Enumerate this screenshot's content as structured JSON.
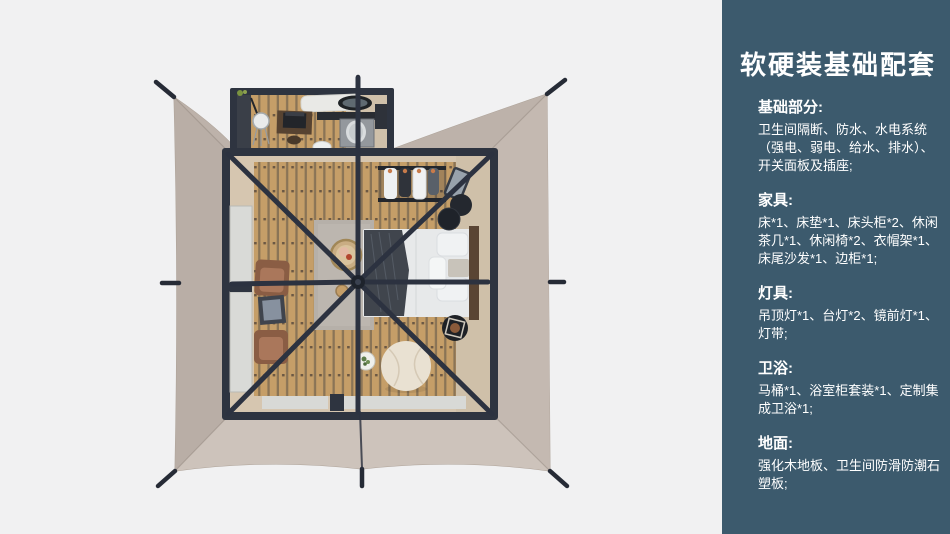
{
  "panel": {
    "title": "软硬装基础配套",
    "sections": [
      {
        "heading": "基础部分:",
        "lines": [
          "卫生间隔断、防水、水电系统",
          "（强电、弱电、给水、排水）、",
          "开关面板及插座;"
        ]
      },
      {
        "heading": "家具:",
        "lines": [
          "床*1、床垫*1、床头柜*2、休闲",
          "茶几*1、休闲椅*2、衣帽架*1、",
          "床尾沙发*1、边柜*1;"
        ]
      },
      {
        "heading": "灯具:",
        "lines": [
          "吊顶灯*1、台灯*2、镜前灯*1、",
          "灯带;"
        ]
      },
      {
        "heading": "卫浴:",
        "lines": [
          "马桶*1、浴室柜套装*1、定制集",
          "成卫浴*1;"
        ]
      },
      {
        "heading": "地面:",
        "lines": [
          "强化木地板、卫生间防滑防潮石",
          "塑板;"
        ]
      }
    ]
  },
  "scene": {
    "description": "top-down 3d render of a square glamping tent: taupe canopy with guy-line stakes, open roof showing bedroom (bed, rug, armchairs, clothes rack, beanbag) and bathroom annex at top",
    "palette": {
      "background": "#f1f1f2",
      "panel_background": "#3c5a6d",
      "panel_text": "#ffffff",
      "canopy_fabric": "#c3b8b0",
      "canopy_north": "#bdb2aa",
      "canopy_east": "#c4b9b1",
      "canopy_south": "#cdc3bb",
      "canopy_west": "#b9aea6",
      "frame_dark": "#2e3440",
      "interior_beige": "#d6c6b0",
      "wood_plank": "#c59e68",
      "bedding_white": "#e8eaeb",
      "throw_dark": "#40454d",
      "armchair_brown": "#a06c52",
      "rug_gray": "#b6b0a9"
    }
  }
}
